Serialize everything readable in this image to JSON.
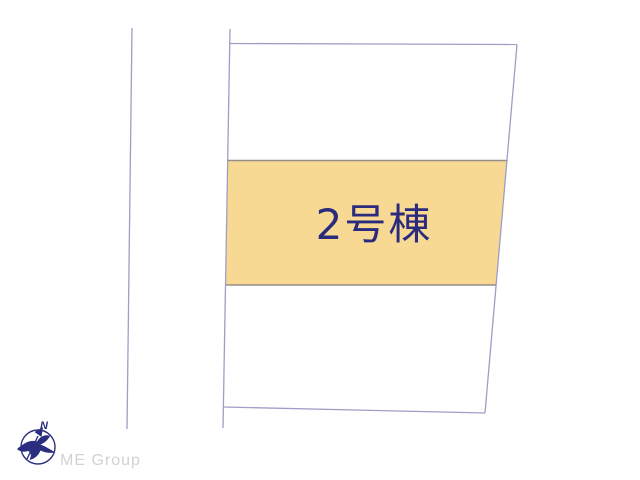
{
  "page": {
    "background_color": "#ffffff"
  },
  "site_plan": {
    "building_label": "2号棟",
    "highlight_fill": "#F8D994",
    "label_color": "#2B2B7D",
    "boundary_color": "#9E9EC6",
    "divider_color": "#948D89"
  },
  "branding": {
    "company_name": "ME Group",
    "company_name_color": "#D2D2D2",
    "compass_color": "#2B2E7F",
    "north_label": "N"
  }
}
